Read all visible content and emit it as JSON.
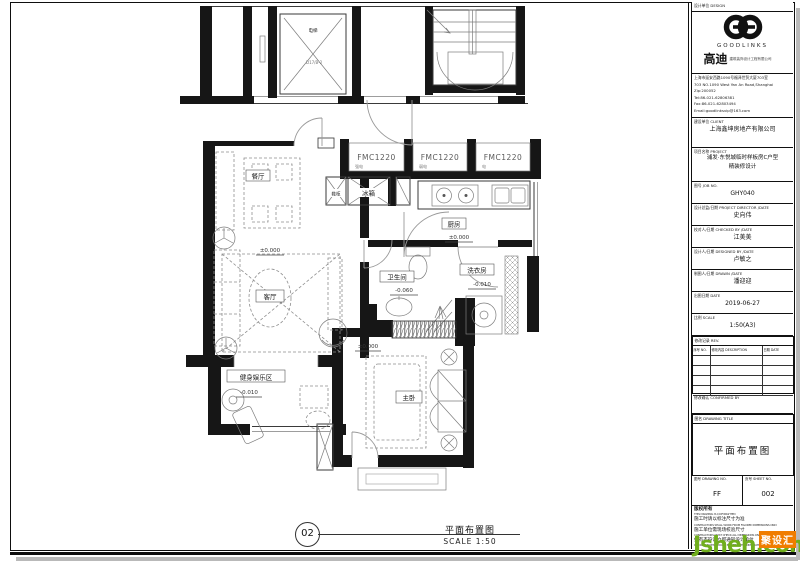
{
  "callout": {
    "number": "02",
    "title": "平面布置图",
    "scale": "SCALE 1:50"
  },
  "plan": {
    "rooms": {
      "dining": "餐厅",
      "living": "客厅",
      "kitchen": "厨房",
      "bath": "卫生间",
      "laundry": "洗衣房",
      "gym": "健身娱乐区",
      "master": "主卧"
    },
    "fixtures": {
      "shoe": "鞋柜",
      "fridge": "冰箱",
      "elevator": "电梯",
      "elevator_code": "D17/B-2"
    },
    "closets": [
      "FMC1220",
      "FMC1220",
      "FMC1220"
    ],
    "closet_subs": [
      "强电",
      "弱电",
      "电"
    ],
    "elevations": {
      "zero": "±0.000",
      "minus10": "-0.010",
      "minus60": "-0.060"
    }
  },
  "titleblock": {
    "design_header": "设计单位 DESIGN",
    "logo_word": "GOODLINKS",
    "brand_cn": "高迪",
    "brand_sub": "建筑装饰设计工程有限公司",
    "address": [
      "上海市延安西路1090号福泽世贸大厦703室",
      "703 NO.1090 West Yan An Road,Shanghai",
      "Zip:200052",
      "Tel:86-021-62806381",
      "Fax:86-021-62803494",
      "Email:goodlinksvip@163.com"
    ],
    "client_header": "建设单位 CLIENT",
    "client_name": "上海鑫坤房地产有限公司",
    "project_header": "项目名称 PROJECT",
    "project_line1": "浦发·东悦城临时样板房C户型",
    "project_line2": "精装修设计",
    "job_header": "图号 JOB NO.",
    "job_no": "GHY040",
    "director_header": "设计总监/日期 PROJECT DIRECTOR /DATE",
    "director": "史向伟",
    "checker_header": "校对人/日期 CHECKED BY /DATE",
    "checker": "江美美",
    "designer_header": "设计人/日期 DESIGNED BY /DATE",
    "designer": "卢敏之",
    "drafter_header": "制图人/日期 DRAWN /DATE",
    "drafter": "潘迎迎",
    "date_header": "出图日期 DATE",
    "date": "2019-06-27",
    "scale_header": "比例 SCALE",
    "scale": "1:50(A3)",
    "rev_header": "修改记录 REV.",
    "rev_cols": {
      "no": "序号 NO.",
      "desc": "修改内容 DESCRIPTION",
      "date": "日期 DATE"
    },
    "confirm_header": "修改确认 CONFIRMED BY",
    "title_header": "图名 DRAWING TITLE",
    "drawing_title": "平面布置图",
    "dwg_header": "图号 DRAWING NO.",
    "dwg_no": "FF",
    "sheet_header": "页号 SHEET NO.",
    "sheet_no": "002",
    "copyright": {
      "l1": "版权所有",
      "l2": "THIS DRAWING IS COPYRIGHTED",
      "l3": "施工时请以标注尺寸为准",
      "l4": "CONTRACTORS SHALL WORK FROM FIGURED DIMENSIONS ONLY",
      "l5": "施工单位需现场校验尺寸",
      "l6": "CONTRACTORS MUST CHECK ALL DIMENSIONS ON SITE",
      "l7": "如有不符请立即通知设计单位",
      "l8": "DISCREPANCIES SHOULD BE REPORTED IMMEDIATELY TO DESIGNERS"
    }
  },
  "watermark": {
    "site": "Jsheh.com",
    "badge": "聚设汇"
  }
}
